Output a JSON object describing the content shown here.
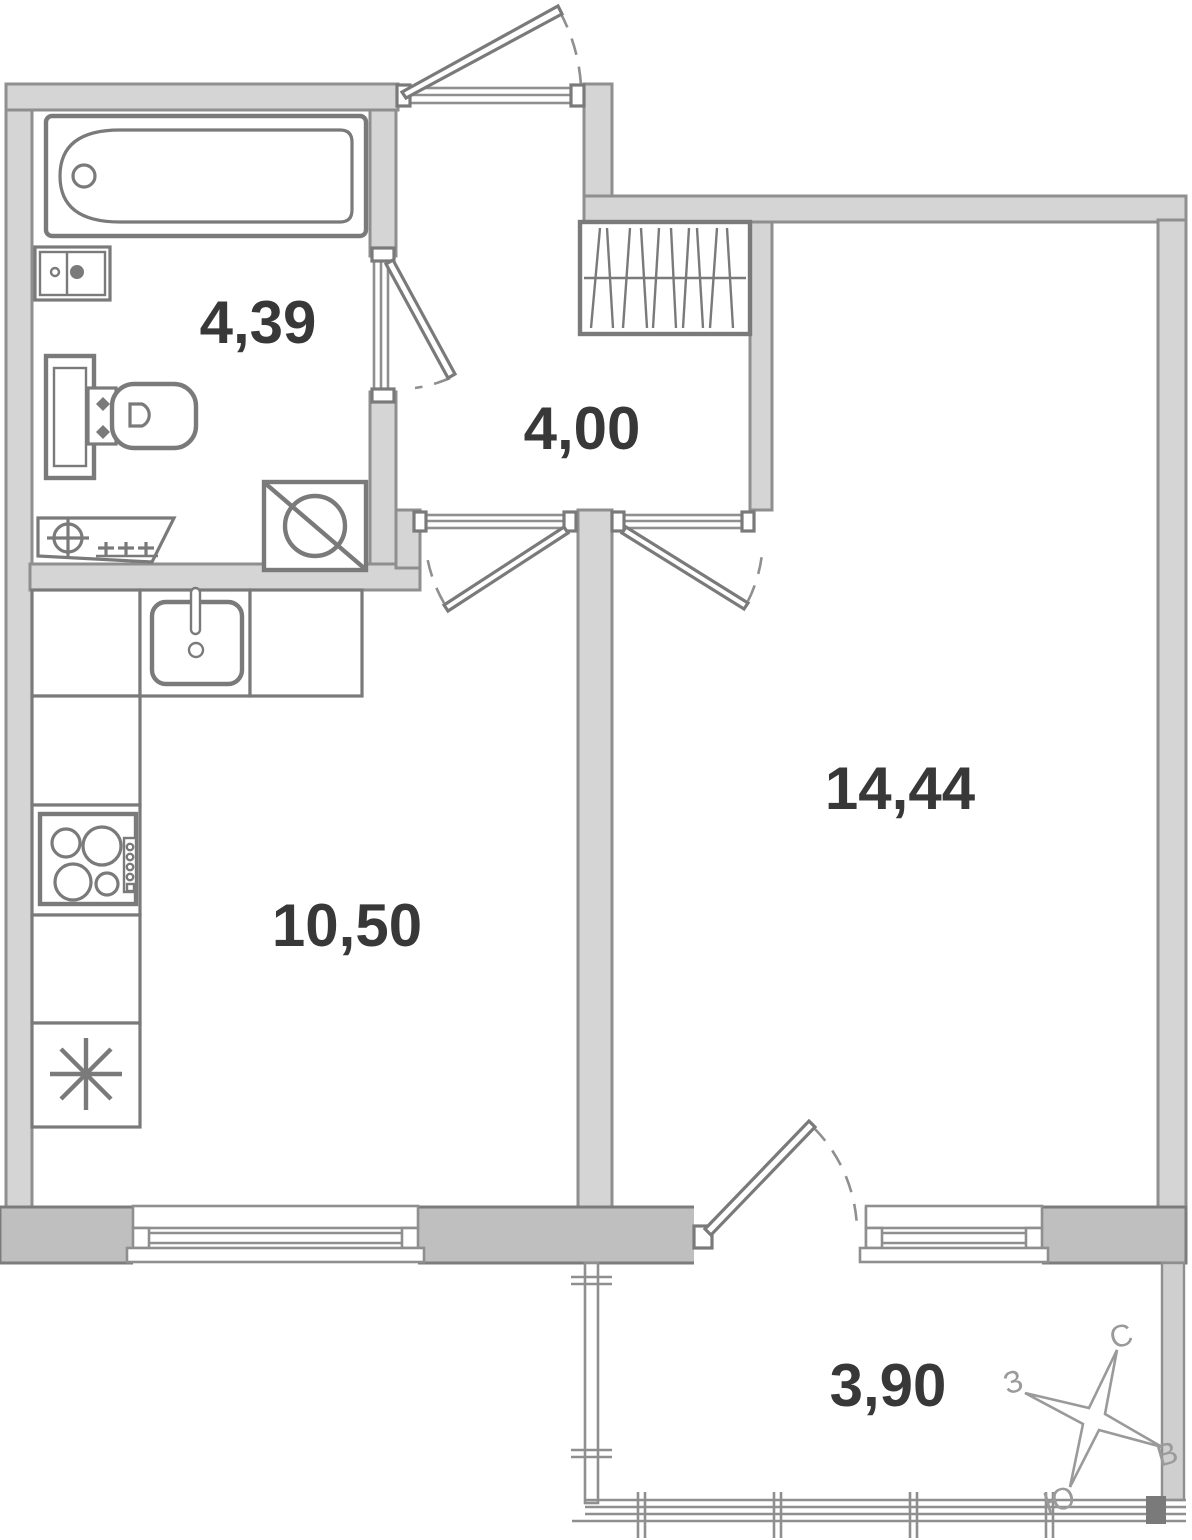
{
  "floorplan": {
    "rooms": {
      "bathroom": {
        "area_label": "4,39"
      },
      "hallway": {
        "area_label": "4,00"
      },
      "living_room": {
        "area_label": "14,44"
      },
      "kitchen": {
        "area_label": "10,50"
      },
      "balcony": {
        "area_label": "3,90"
      }
    },
    "compass": {
      "north_label": "С",
      "east_label": "В",
      "south_label": "Ю",
      "west_label": "З"
    },
    "colors": {
      "background": "#ffffff",
      "wall_light": "#d5d5d5",
      "wall_dark": "#bfbfbf",
      "outline": "#8f8f8f",
      "outline_dark": "#7c7c7c",
      "fixture": "#7a7a7a",
      "label": "#383838",
      "compass": "#9a9a9a"
    }
  }
}
